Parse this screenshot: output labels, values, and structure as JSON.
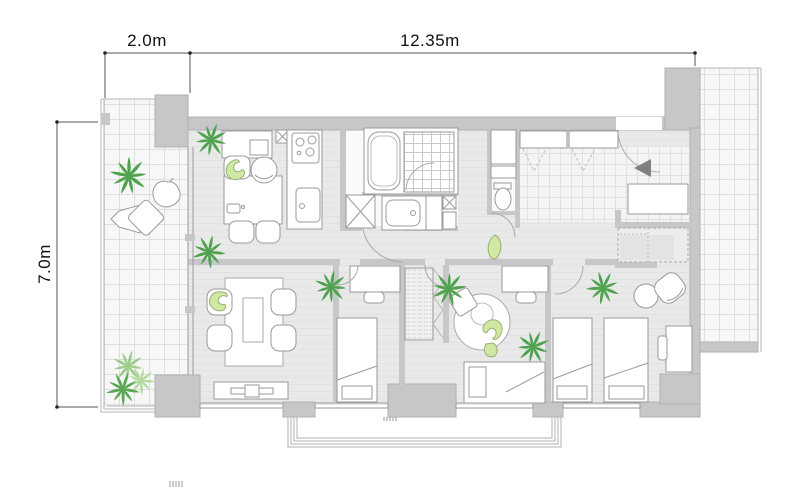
{
  "plan": {
    "type": "apartment-floor-plan",
    "dimension_labels": {
      "width_left": "2.0m",
      "width_main": "12.35m",
      "height": "7.0m"
    },
    "colors": {
      "wall": "#c7c7c9",
      "wall_edge": "#b0b0b2",
      "floor": "#e9e9ea",
      "floor_stripe": "#e2e2e3",
      "tile_bg": "#f7f7f7",
      "tile_line": "#dedede",
      "outline": "#8f8f91",
      "plant_dark": "#4fa24e",
      "plant_light": "#9ccd8a",
      "figure_green": "#cfe8a3",
      "figure_edge": "#96b072",
      "entry_arrow": "#808083",
      "dim_line": "#555555",
      "text": "#111111"
    },
    "areas": [
      "balcony-left",
      "living-dining-kitchen",
      "bathroom",
      "washroom",
      "toilet-room",
      "entrance-hall",
      "walk-in-closet",
      "bedroom-1",
      "bedroom-2",
      "master-bedroom",
      "porch-right",
      "balcony-rail-bottom"
    ],
    "icons": [
      "palm-plant-icon",
      "seated-person-icon",
      "bathtub-icon",
      "shower-tile-icon",
      "toilet-icon",
      "stove-icon",
      "kitchen-sink-icon",
      "washing-machine-icon",
      "dining-table-icon",
      "kettle-icon",
      "sofa-chair-icon",
      "low-table-icon",
      "tv-board-icon",
      "bed-icon",
      "desk-icon",
      "round-rug-icon",
      "round-table-icon",
      "lounge-chair-icon",
      "cushion-icon",
      "beanbag-icon",
      "entry-arrow-icon",
      "closet-icon",
      "leaf-plant-icon"
    ]
  }
}
